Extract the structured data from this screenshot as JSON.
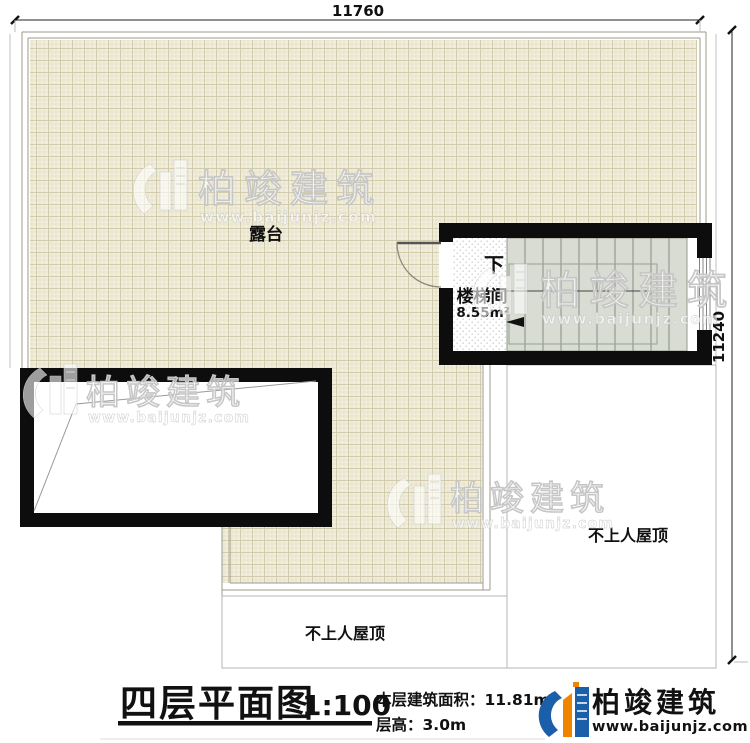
{
  "plan": {
    "dimension_top": "11760",
    "dimension_right": "11240",
    "terrace_label": "露台",
    "stairwell": {
      "name": "楼梯间",
      "area": "8.55m²",
      "direction": "下"
    },
    "roof_right_label": "不上人屋顶",
    "roof_bottom_label": "不上人屋顶"
  },
  "title_block": {
    "title": "四层平面图",
    "scale": "1:100",
    "area_label": "本层建筑面积：",
    "area_value": "11.81m²",
    "height_label": "层高：",
    "height_value": "3.0m"
  },
  "branding": {
    "watermark_name": "柏竣建筑",
    "watermark_url": "www.baijunjz.com",
    "logo_name": "柏竣建筑",
    "logo_url": "www.baijunjz.com"
  },
  "colors": {
    "tile_fill": "#f1eedd",
    "tile_line": "#d9d4b6",
    "stair_fill": "#d8dcd2",
    "wall": "#0d0d0d",
    "logo_blue": "#1b5ea9",
    "logo_orange": "#f08300"
  }
}
